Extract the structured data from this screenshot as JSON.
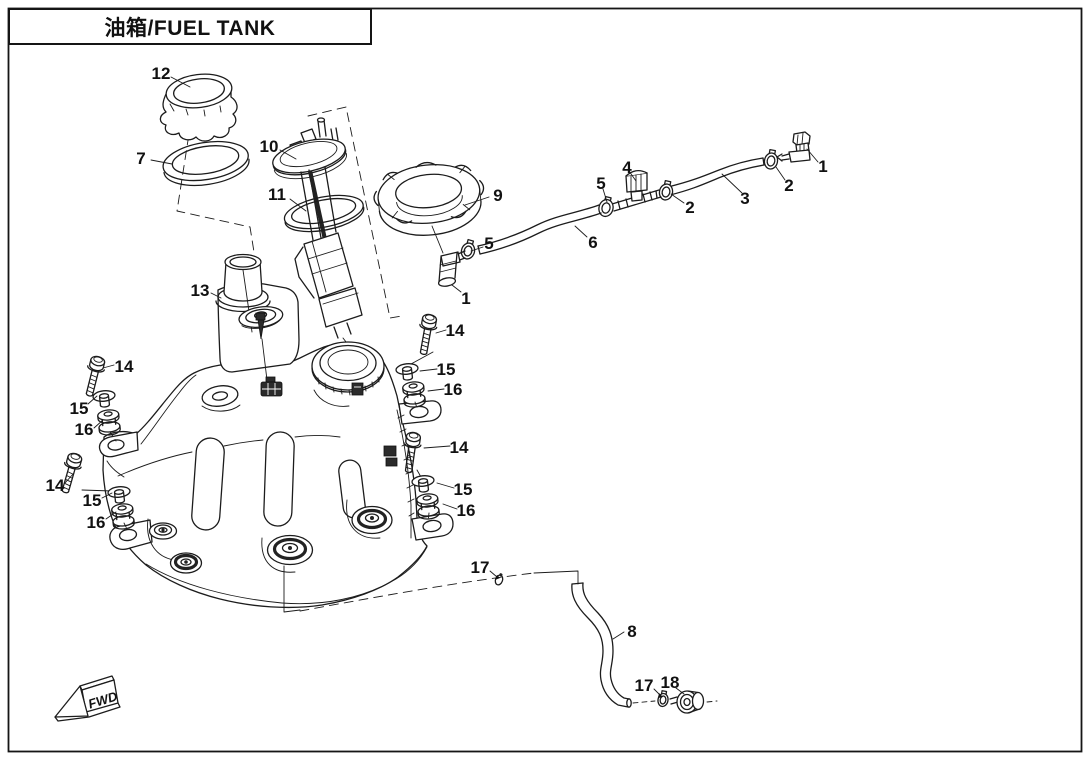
{
  "title": {
    "text": "油箱/FUEL TANK"
  },
  "colors": {
    "line": "#1c1c1c",
    "background": "#ffffff"
  },
  "diagram": {
    "fwd_label": "FWD",
    "part_labels": [
      {
        "text": "12",
        "x": 161,
        "y": 73
      },
      {
        "text": "7",
        "x": 141,
        "y": 158
      },
      {
        "text": "10",
        "x": 269,
        "y": 146
      },
      {
        "text": "11",
        "x": 277,
        "y": 194
      },
      {
        "text": "9",
        "x": 498,
        "y": 195
      },
      {
        "text": "4",
        "x": 627,
        "y": 167
      },
      {
        "text": "5",
        "x": 601,
        "y": 183
      },
      {
        "text": "2",
        "x": 690,
        "y": 207
      },
      {
        "text": "3",
        "x": 745,
        "y": 198
      },
      {
        "text": "2",
        "x": 789,
        "y": 185
      },
      {
        "text": "1",
        "x": 823,
        "y": 166
      },
      {
        "text": "5",
        "x": 489,
        "y": 243
      },
      {
        "text": "6",
        "x": 593,
        "y": 242
      },
      {
        "text": "1",
        "x": 466,
        "y": 298
      },
      {
        "text": "13",
        "x": 200,
        "y": 290
      },
      {
        "text": "14",
        "x": 455,
        "y": 330
      },
      {
        "text": "15",
        "x": 446,
        "y": 369
      },
      {
        "text": "16",
        "x": 453,
        "y": 389
      },
      {
        "text": "14",
        "x": 124,
        "y": 366
      },
      {
        "text": "15",
        "x": 79,
        "y": 408
      },
      {
        "text": "16",
        "x": 84,
        "y": 429
      },
      {
        "text": "14",
        "x": 55,
        "y": 485
      },
      {
        "text": "15",
        "x": 92,
        "y": 500
      },
      {
        "text": "16",
        "x": 96,
        "y": 522
      },
      {
        "text": "14",
        "x": 459,
        "y": 447
      },
      {
        "text": "15",
        "x": 463,
        "y": 489
      },
      {
        "text": "16",
        "x": 466,
        "y": 510
      },
      {
        "text": "17",
        "x": 480,
        "y": 567
      },
      {
        "text": "8",
        "x": 632,
        "y": 631
      },
      {
        "text": "17",
        "x": 644,
        "y": 685
      },
      {
        "text": "18",
        "x": 670,
        "y": 682
      }
    ]
  }
}
